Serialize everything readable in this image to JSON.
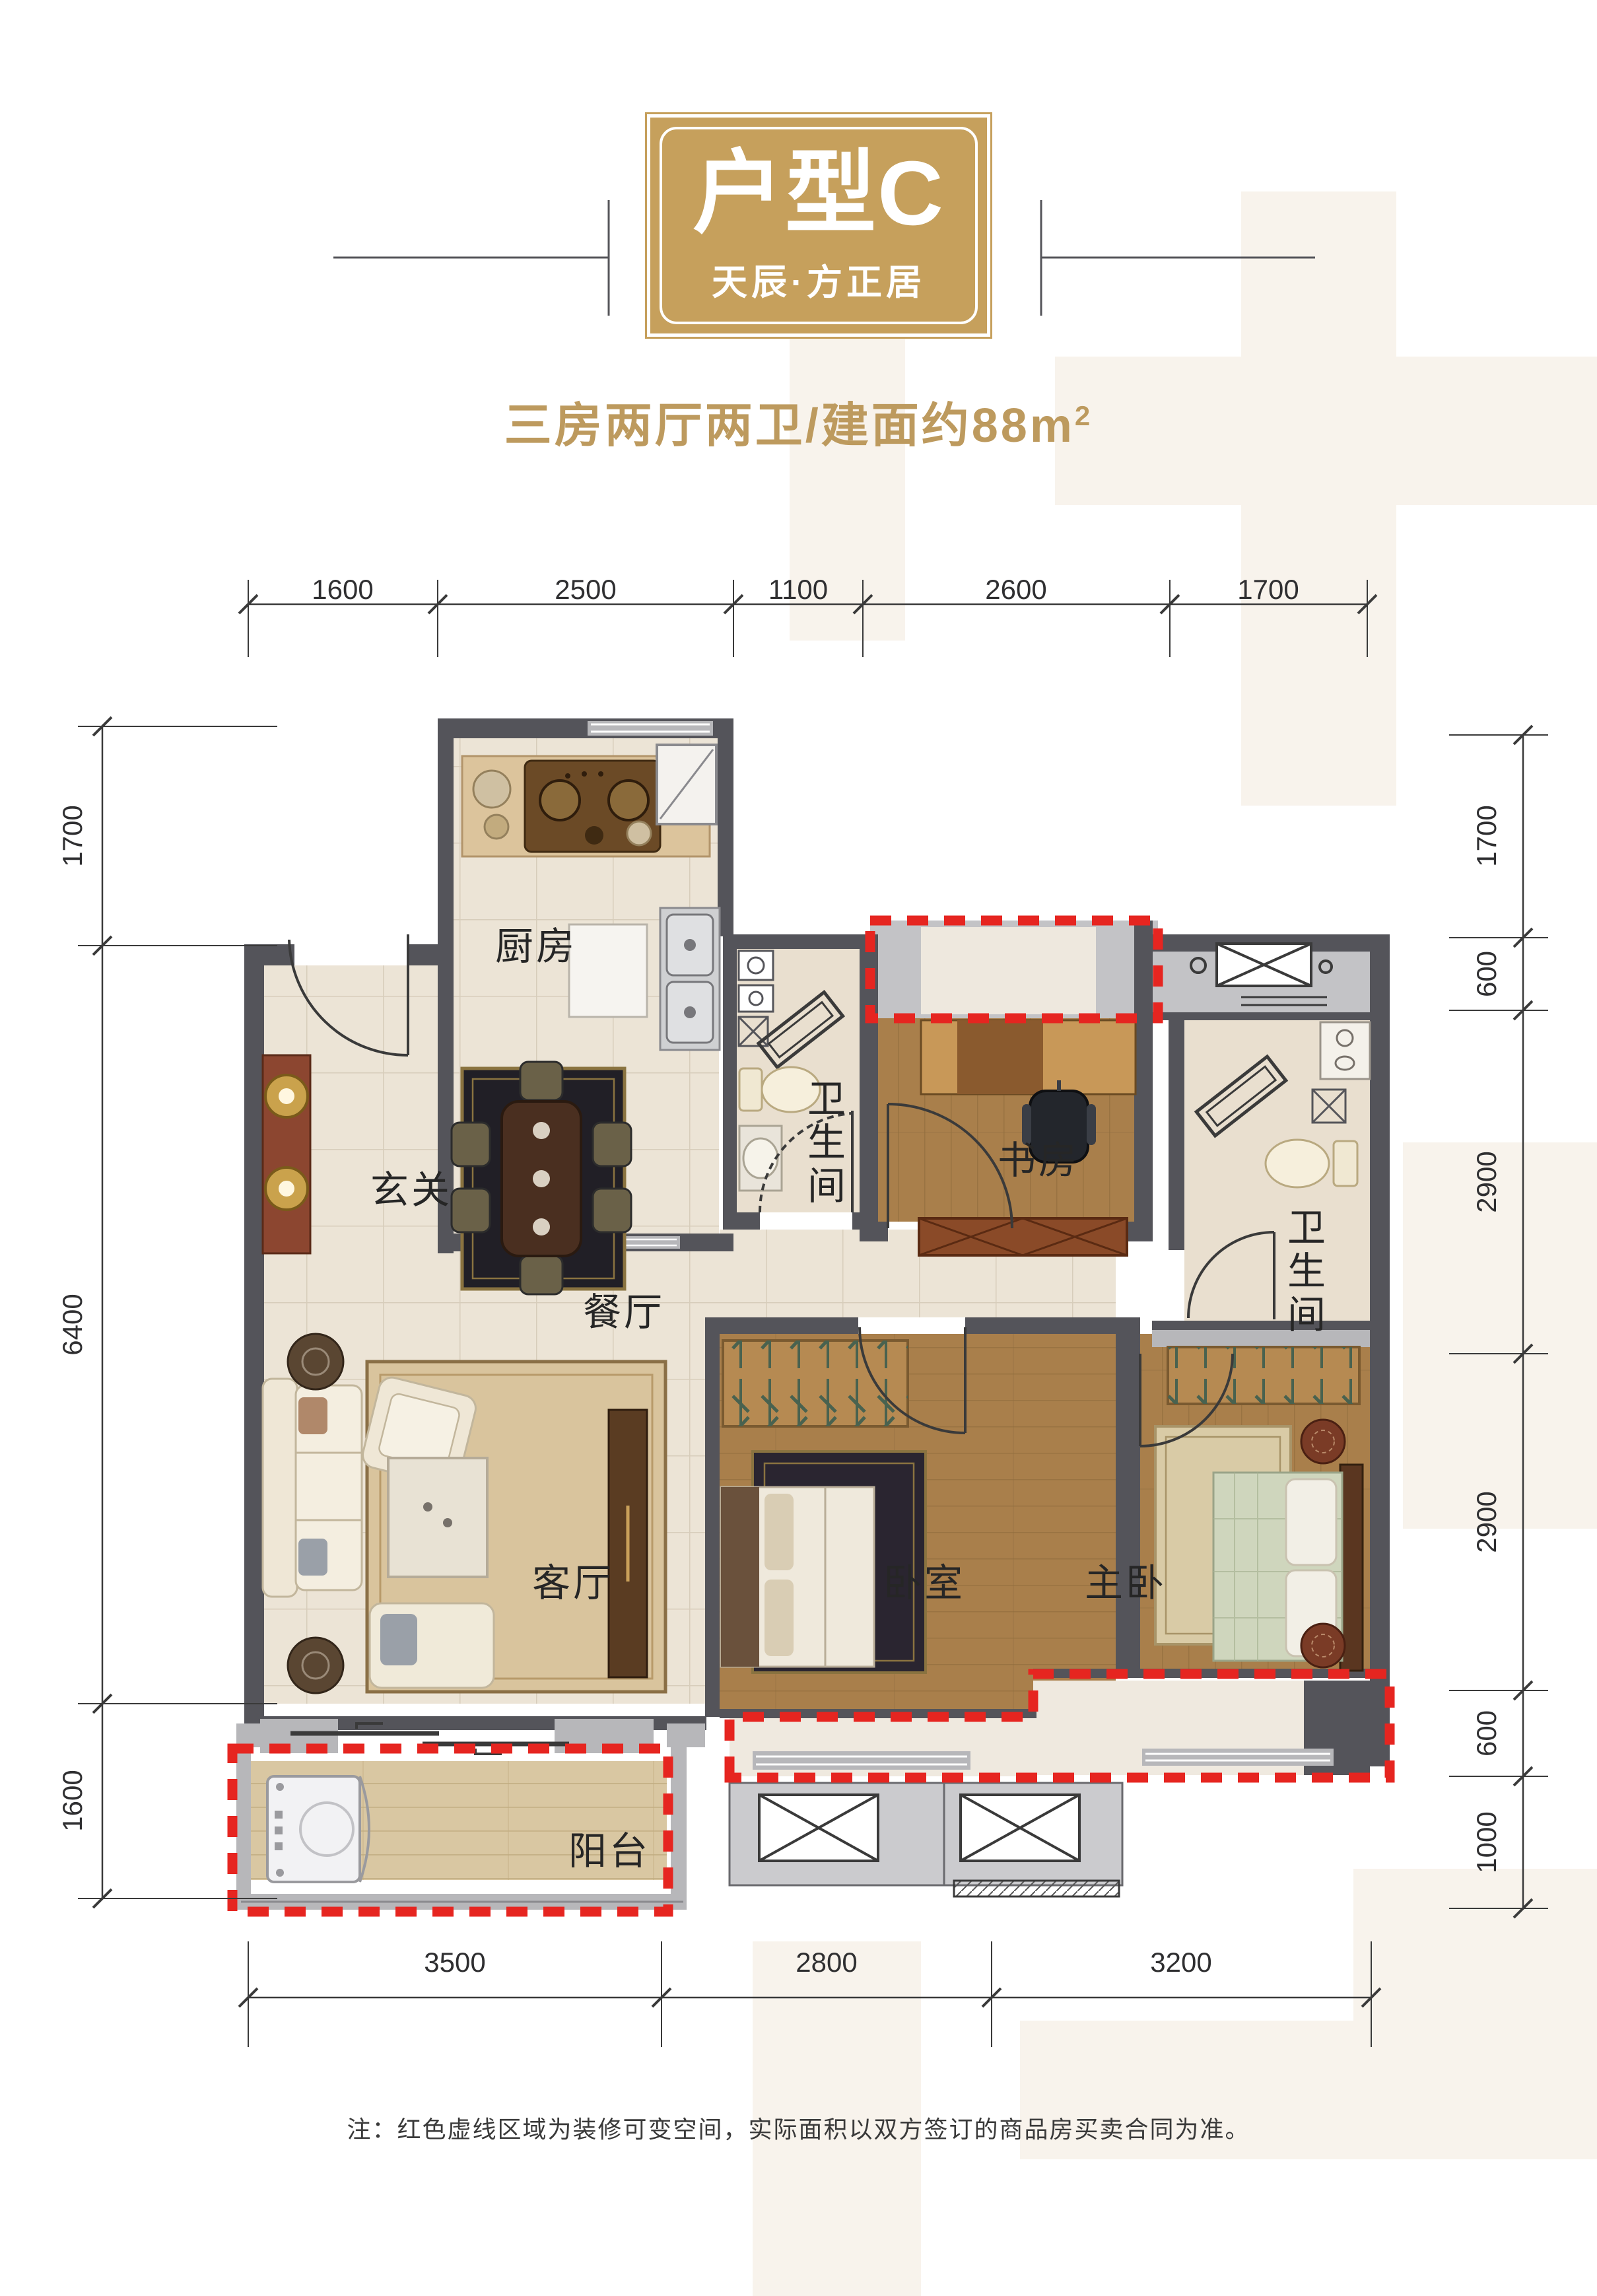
{
  "header": {
    "badge_title": "户型C",
    "badge_subtitle": "天辰·方正居",
    "summary_main": "三房两厅两卫/建面约88m",
    "summary_sup": "2"
  },
  "dimensions": {
    "top": [
      "1600",
      "2500",
      "1100",
      "2600",
      "1700"
    ],
    "bottom": [
      "3500",
      "2800",
      "3200"
    ],
    "left": [
      "1700",
      "6400",
      "1600"
    ],
    "right": [
      "1700",
      "600",
      "2900",
      "2900",
      "600",
      "1000"
    ]
  },
  "rooms": {
    "kitchen": "厨房",
    "entry": "玄关",
    "dining": "餐厅",
    "living": "客厅",
    "bedroom": "卧室",
    "master": "主卧",
    "study": "书房",
    "bath1": "卫生间",
    "bath2": "卫生间",
    "balcony": "阳台"
  },
  "note": "注：红色虚线区域为装修可变空间，实际面积以双方签订的商品房买卖合同为准。",
  "colors": {
    "badge_gold": "#C6A05C",
    "summary_gold": "#BD9A5E",
    "wall_dark": "#54545A",
    "wall_light": "#B7B7BA",
    "red_dashed": "#E62520",
    "tile_floor": "#ECE4D6",
    "wood_floor": "#A97F4B",
    "balcony_floor": "#D9C7A2"
  }
}
